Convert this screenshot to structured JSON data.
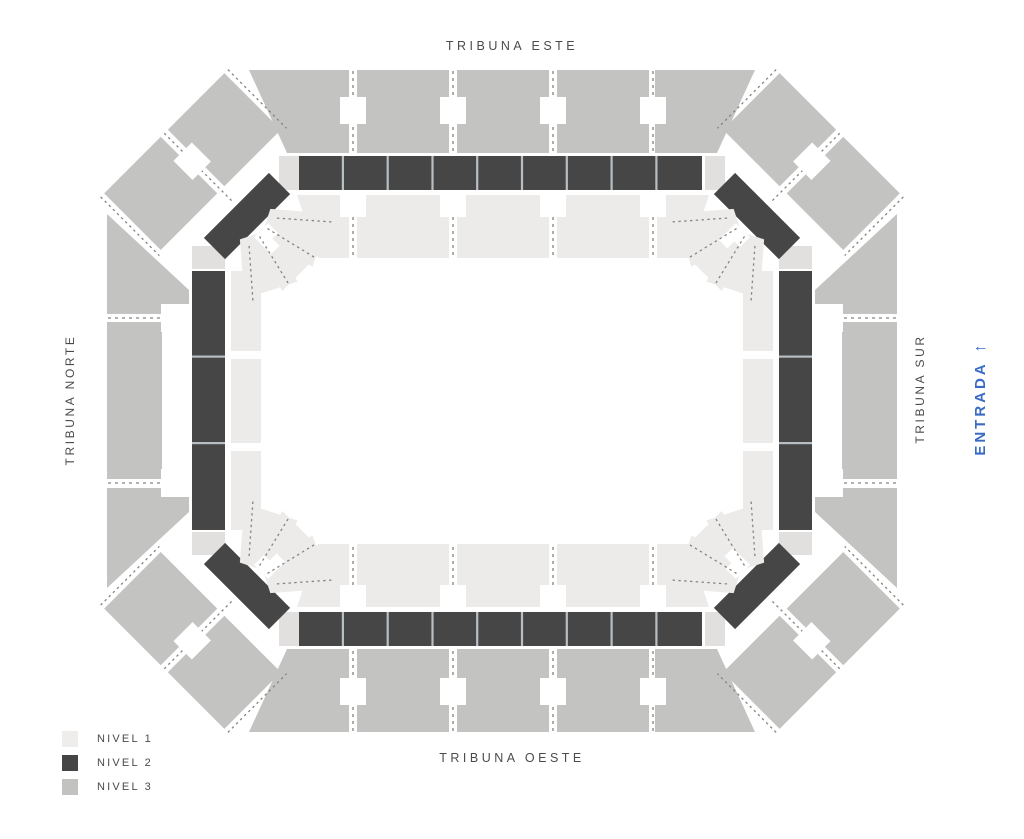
{
  "stands": {
    "top": "TRIBUNA ESTE",
    "bottom": "TRIBUNA OESTE",
    "left": "TRIBUNA NORTE",
    "right": "TRIBUNA SUR"
  },
  "entrance": {
    "label": "ENTRADA",
    "arrow": "↑",
    "color": "#3A6BC4",
    "side": "right"
  },
  "legend": {
    "items": [
      {
        "label": "NIVEL 1",
        "color": "#EEEDEB"
      },
      {
        "label": "NIVEL 2",
        "color": "#454545"
      },
      {
        "label": "NIVEL 3",
        "color": "#C2C2C1"
      }
    ]
  },
  "map": {
    "kind": "stadium-seating-plan",
    "rings": {
      "nivel1": "inner ring",
      "nivel2": "middle ring",
      "nivel3": "outer ring"
    },
    "nivel2_section_counts": {
      "este_band": 9,
      "oeste_band": 9,
      "norte_band": 3,
      "sur_band": 3,
      "corner_blocks": 4
    }
  }
}
